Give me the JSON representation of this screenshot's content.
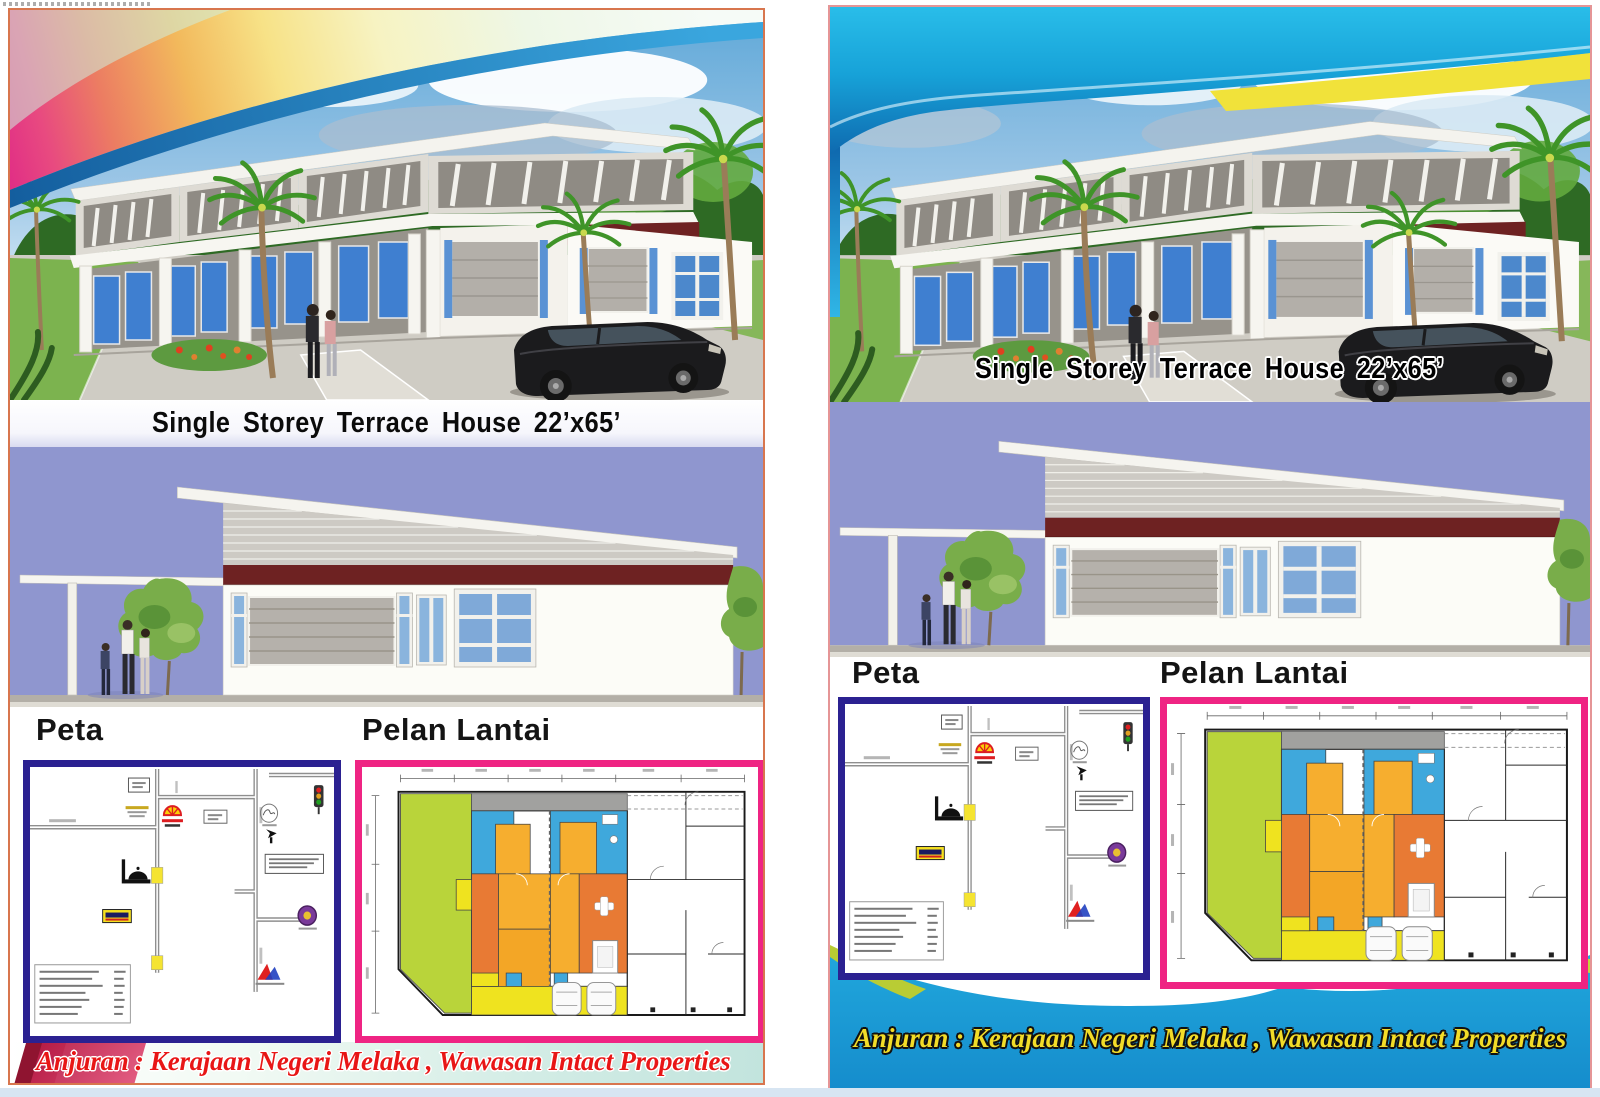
{
  "page": {
    "background": "#ffffff",
    "bottom_strip_color": "#d7e5f2"
  },
  "palette": {
    "left_flyer_border": "#d8764e",
    "right_flyer_border": "#e59596",
    "map_box_border": "#2b2191",
    "floor_plan_box_border": "#ef2483",
    "elevation_background": "#8f96cf",
    "roof_fascia_maroon": "#6e2222",
    "plan_yard_green": "#b9d43a",
    "plan_bedroom_blue": "#3fa8dc",
    "plan_living_orange": "#e87a34",
    "plan_room_amber": "#f6ae2f",
    "plan_porch_yellow": "#efe31f",
    "left_footer_text_color": "#e81616",
    "right_footer_text_color": "#f2dc28",
    "right_footer_background": "#1b9fd9",
    "header_wave_cyan": "#25b5e6",
    "header_wave_yellow": "#f1e23a"
  },
  "flyers": [
    {
      "title": "Single Storey Terrace House 22’x65’",
      "map_heading": "Peta",
      "plan_heading": "Pelan Lantai",
      "footer": "Anjuran : Kerajaan Negeri Melaka , Wawasan Intact Properties"
    },
    {
      "title": "Single Storey Terrace House 22’x65’",
      "map_heading": "Peta",
      "plan_heading": "Pelan Lantai",
      "footer": "Anjuran : Kerajaan Negeri Melaka , Wawasan Intact Properties"
    }
  ],
  "map": {
    "landmark_icons": [
      "petrol-station-logo",
      "supermarket-sign",
      "mosque",
      "traffic-light",
      "landmark-emblem",
      "developer-logo",
      "info-box",
      "distance-legend"
    ],
    "legend_row_count": 7
  },
  "floor_plan": {
    "features": [
      "garden",
      "back-lane",
      "bedrooms",
      "living-area",
      "bathrooms",
      "car-porch",
      "two-cars",
      "adjacent-units-outline"
    ]
  }
}
